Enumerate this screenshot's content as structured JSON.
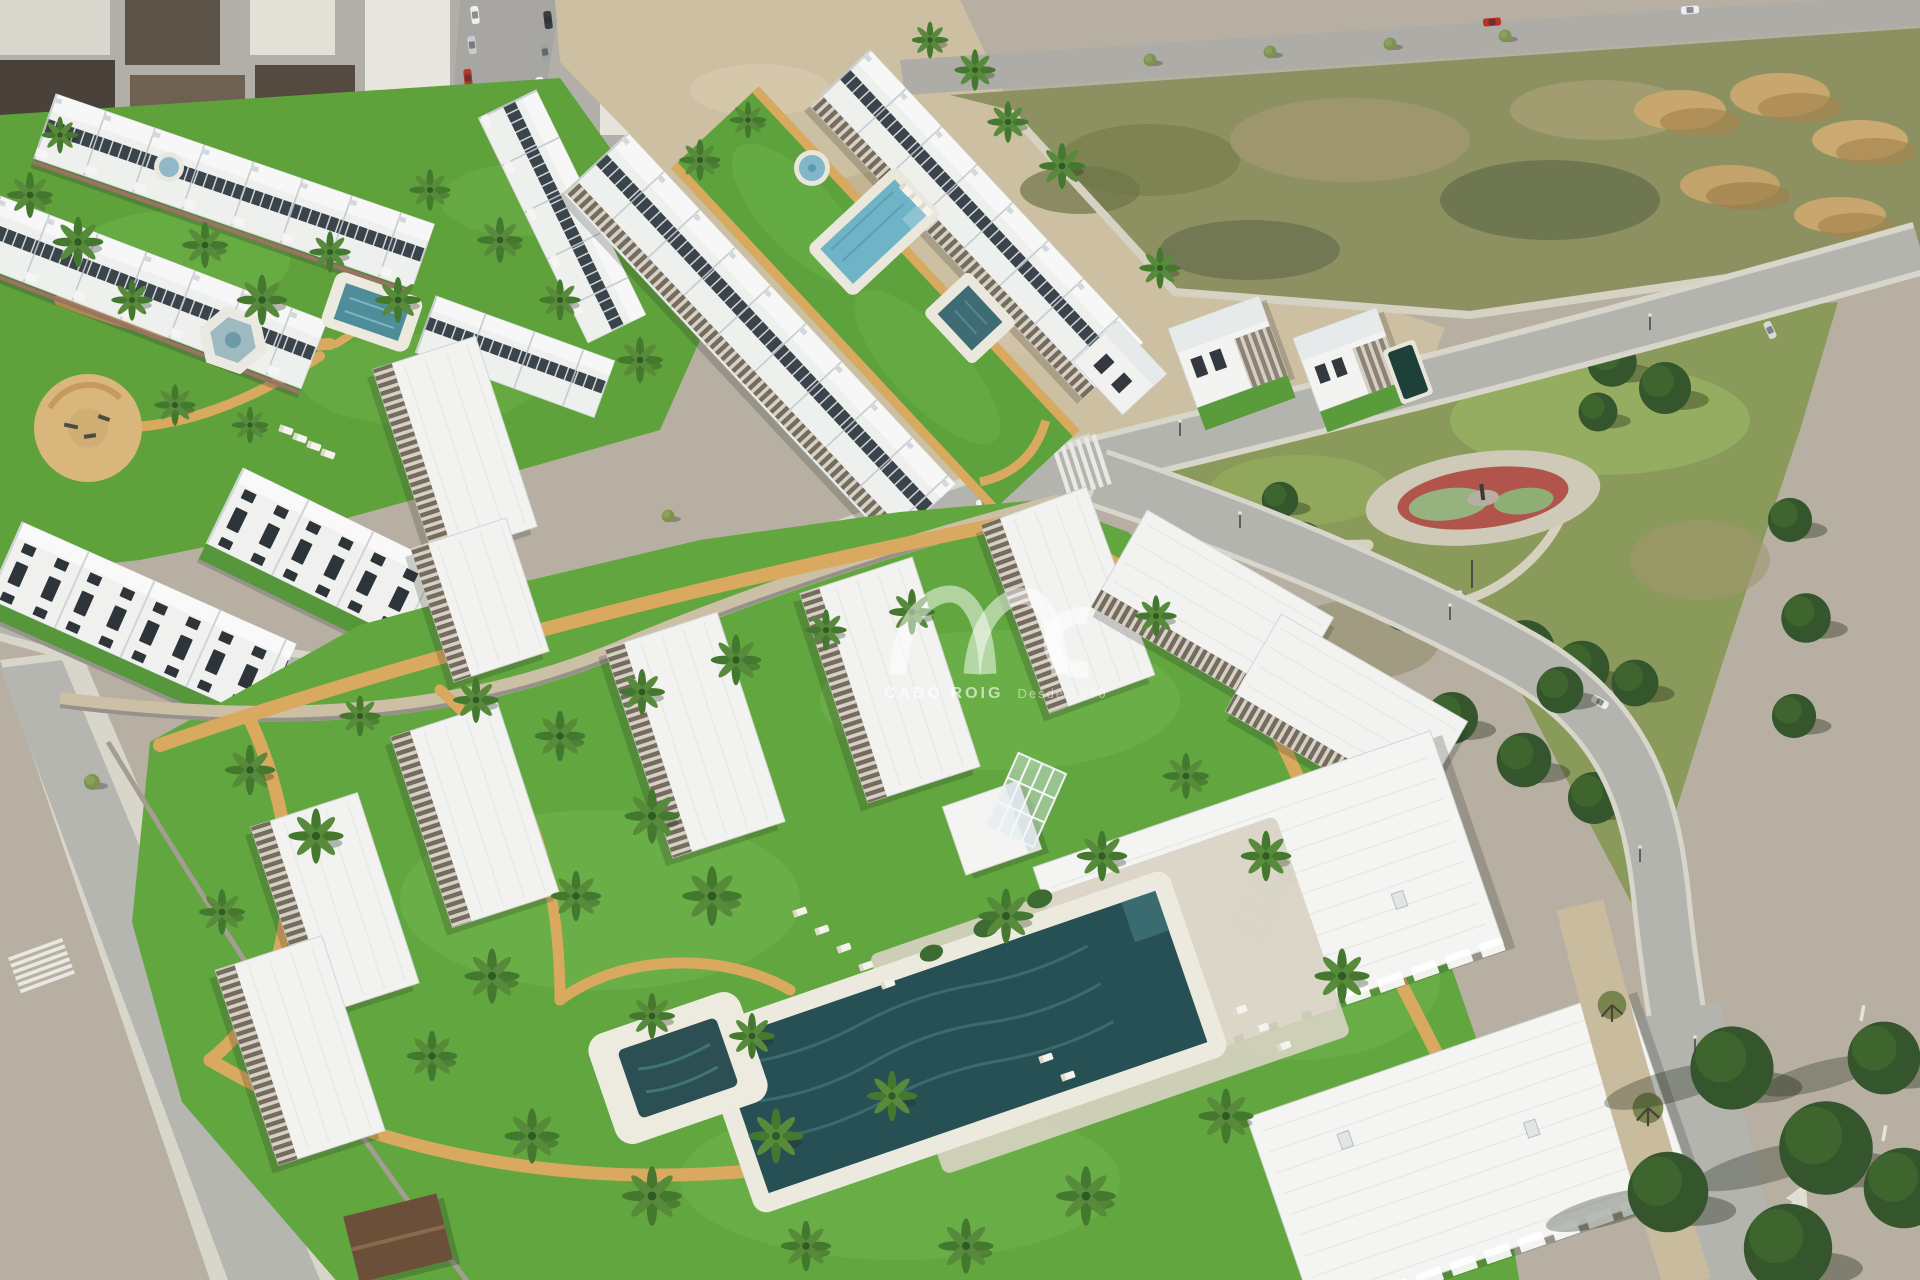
{
  "watermark": {
    "brand": "CABO ROIG",
    "tagline": "Desde 1970",
    "color": "#ffffff",
    "opacity": 0.52
  },
  "scene": {
    "label": "aerial-3d-render-of-new-build-residential-development",
    "regions": [
      "existing-town",
      "town-streets",
      "vacant-scrub-lot",
      "sand-mounds",
      "perimeter-roads",
      "public-park",
      "playground-red-track",
      "park-kiosk",
      "upper-left-residence-complex",
      "central-plaza",
      "hexagon-fountain",
      "community-lap-pool",
      "round-fountain-pool",
      "square-plunge-pool",
      "traditional-townhouse-rows",
      "detached-villas",
      "villa-pool",
      "main-apartment-complex",
      "main-community-pool",
      "kids-pool",
      "pool-loungers",
      "glass-trellis",
      "pool-house-cube",
      "garden-paths",
      "palm-trees",
      "pine-trees",
      "road-crosswalks",
      "street-lamps",
      "cars"
    ]
  },
  "palette": {
    "lawn_green": "#61a63e",
    "scrub_olive": "#8a9a5b",
    "path_sand": "#d9a95f",
    "pool_deep_teal": "#275055",
    "pool_light_blue": "#7fb6c8",
    "roof_white": "#f0f1ef",
    "pergola_brown": "#756c5e",
    "asphalt_gray": "#b4b4af",
    "playground_red": "#b0544c",
    "earth_tan": "#c8a76f"
  }
}
